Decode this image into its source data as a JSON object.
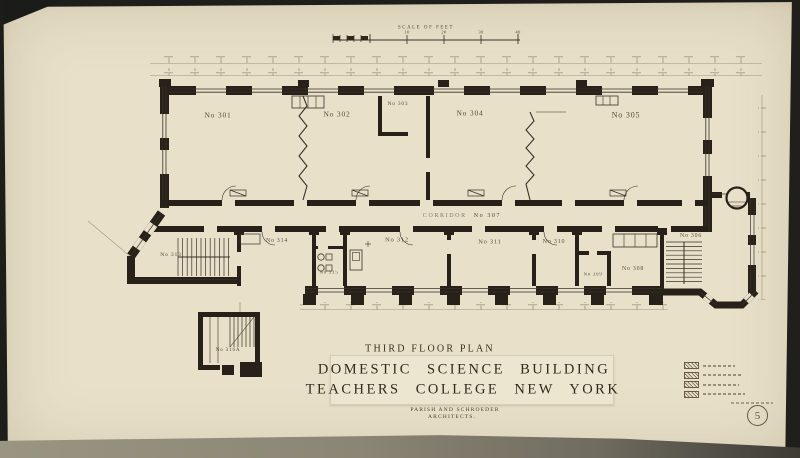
{
  "drawing": {
    "scale_bar": {
      "label": "SCALE OF FEET",
      "ticks": [
        "10",
        "20",
        "30",
        "40"
      ]
    },
    "rooms": {
      "r301": "No 301",
      "r302": "No 302",
      "r303": "No 303",
      "r304": "No 304",
      "r305": "No 305",
      "corridor_word": "CORRIDOR",
      "corridor_no": "No 307",
      "r306": "No 306",
      "r308": "No 308",
      "r309": "No 309",
      "r310": "No 310",
      "r311": "No 311",
      "r312": "No 312",
      "r313": "No 313",
      "r314": "No 314",
      "r315": "No 315",
      "r316a": "No 316A"
    },
    "title_block": {
      "plan_title": "THIRD FLOOR PLAN",
      "building_line1": "DOMESTIC SCIENCE BUILDING",
      "building_line2": "TEACHERS COLLEGE NEW YORK",
      "architects_line1": "PARISH AND SCHROEDER",
      "architects_line2": "ARCHITECTS."
    },
    "stamp_number": "5",
    "colors": {
      "paper": "#e8e0c9",
      "ink": "#2f2719"
    }
  }
}
